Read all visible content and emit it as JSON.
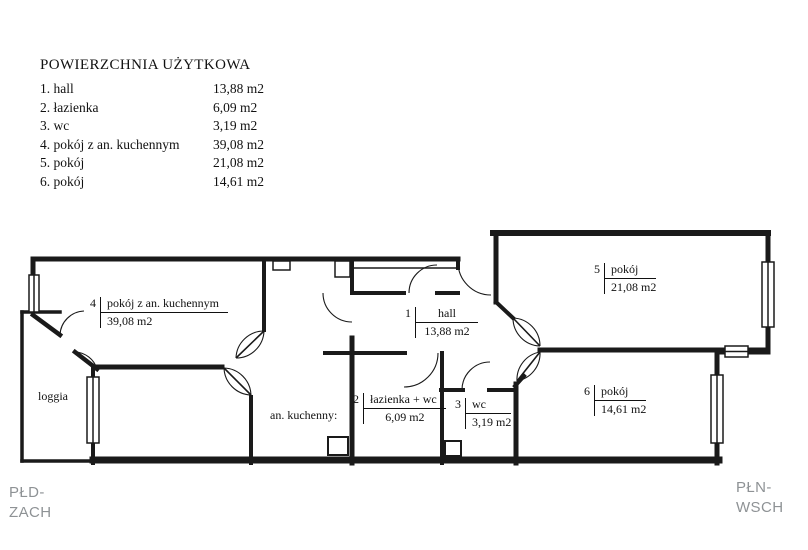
{
  "legend": {
    "title": "POWIERZCHNIA UŻYTKOWA",
    "rows": [
      {
        "name": "1. hall",
        "area": "13,88 m2"
      },
      {
        "name": "2. łazienka",
        "area": "6,09 m2"
      },
      {
        "name": "3. wc",
        "area": "3,19 m2"
      },
      {
        "name": "4. pokój z an. kuchennym",
        "area": "39,08 m2"
      },
      {
        "name": "5. pokój",
        "area": "21,08 m2"
      },
      {
        "name": "6. pokój",
        "area": "14,61 m2"
      }
    ]
  },
  "rooms": [
    {
      "num": "1",
      "name": "hall",
      "area": "13,88 m2"
    },
    {
      "num": "2",
      "name": "łazienka + wc",
      "area": "6,09 m2"
    },
    {
      "num": "3",
      "name": "wc",
      "area": "3,19 m2"
    },
    {
      "num": "4",
      "name": "pokój z an. kuchennym",
      "area": "39,08 m2"
    },
    {
      "num": "5",
      "name": "pokój",
      "area": "21,08 m2"
    },
    {
      "num": "6",
      "name": "pokój",
      "area": "14,61 m2"
    }
  ],
  "annotations": {
    "kitchenette": "an. kuchenny:",
    "loggia": "loggia"
  },
  "compass": {
    "sw": [
      "PŁD-",
      "ZACH"
    ],
    "ne": [
      "PŁN-",
      "WSCH"
    ]
  },
  "colors": {
    "wall": "#1a1a1a",
    "text": "#111111",
    "compass_text": "#8e9295",
    "background": "#ffffff"
  }
}
